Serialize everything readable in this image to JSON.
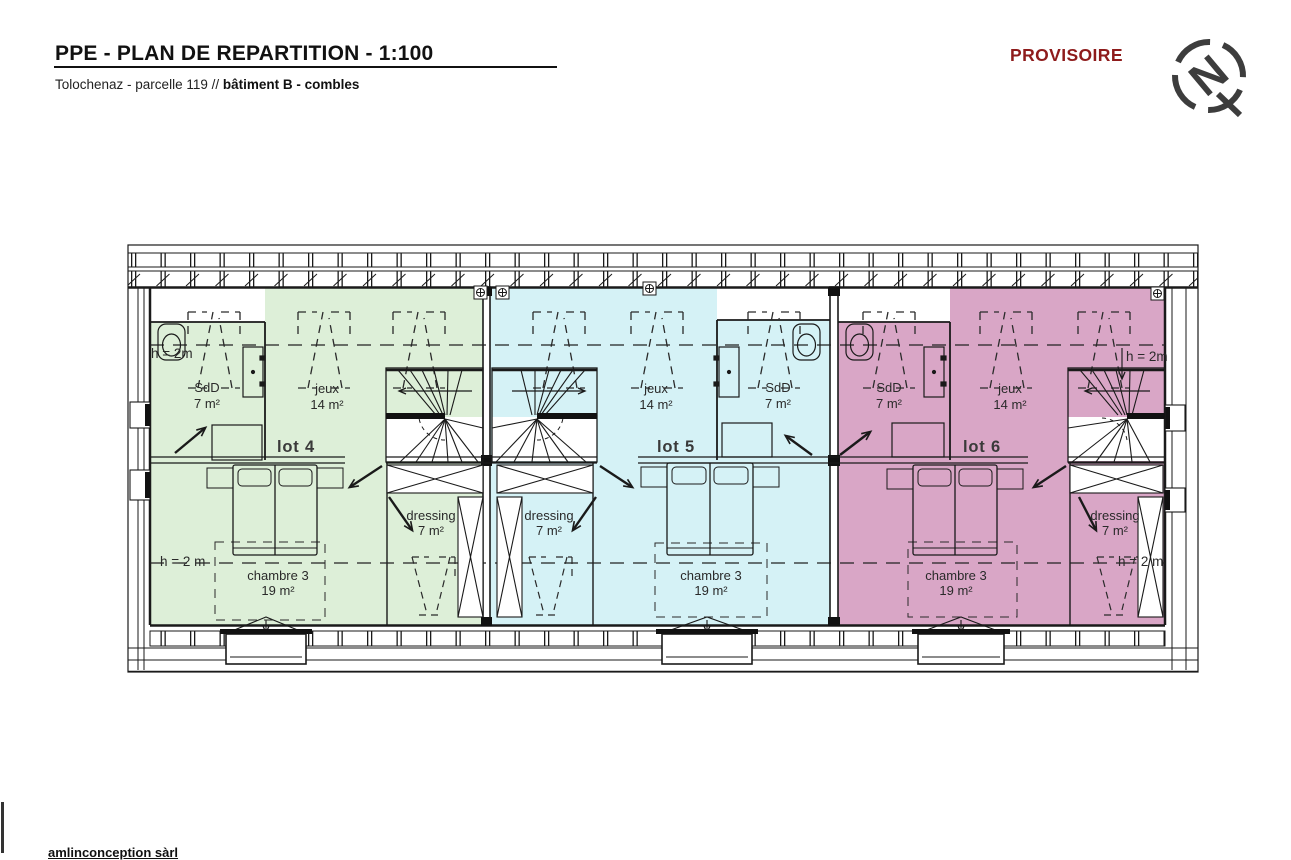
{
  "header": {
    "title": "PPE - PLAN DE REPARTITION - 1:100",
    "subtitle_prefix": "Tolochenaz - parcelle 119 // ",
    "subtitle_bold": "bâtiment B - combles",
    "status": "PROVISOIRE",
    "compass_letter": "N"
  },
  "colors": {
    "lot4_fill": "#ddefd8",
    "lot5_fill": "#d5f2f6",
    "lot6_fill": "#d9a6c6",
    "status_red": "#8e1b1b",
    "line": "#1a1a1a"
  },
  "lots": [
    {
      "id": "lot-4",
      "label": "lot 4",
      "height_note_top": "h = 2m",
      "height_note_bottom": "h = 2 m",
      "rooms": {
        "sdd": {
          "name": "SdD",
          "area": "7 m²"
        },
        "jeux": {
          "name": "jeux",
          "area": "14 m²"
        },
        "dressing": {
          "name": "dressing",
          "area": "7 m²"
        },
        "chambre": {
          "name": "chambre 3",
          "area": "19 m²"
        }
      }
    },
    {
      "id": "lot-5",
      "label": "lot 5",
      "rooms": {
        "sdd": {
          "name": "SdD",
          "area": "7 m²"
        },
        "jeux": {
          "name": "jeux",
          "area": "14 m²"
        },
        "dressing": {
          "name": "dressing",
          "area": "7 m²"
        },
        "chambre": {
          "name": "chambre 3",
          "area": "19 m²"
        }
      }
    },
    {
      "id": "lot-6",
      "label": "lot 6",
      "height_note_top": "h = 2m",
      "height_note_bottom": "h = 2 m",
      "rooms": {
        "sdd": {
          "name": "SdD",
          "area": "7 m²"
        },
        "jeux": {
          "name": "jeux",
          "area": "14 m²"
        },
        "dressing": {
          "name": "dressing",
          "area": "7 m²"
        },
        "chambre": {
          "name": "chambre 3",
          "area": "19 m²"
        }
      }
    }
  ],
  "footer": {
    "company": "amlinconception sàrl"
  }
}
